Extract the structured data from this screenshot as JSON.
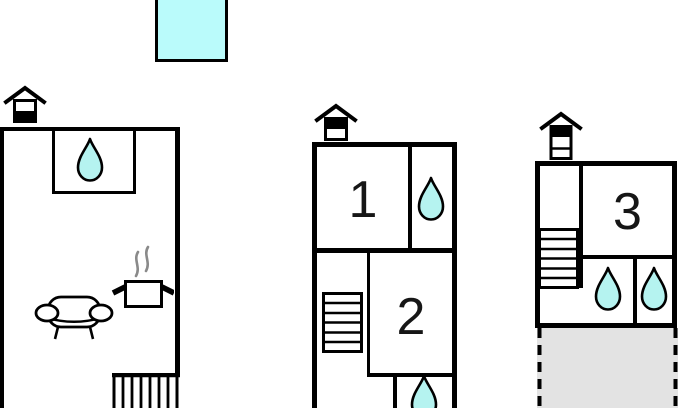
{
  "rooms": [
    {
      "label": "1"
    },
    {
      "label": "2"
    },
    {
      "label": "3"
    }
  ],
  "icons": {
    "pool": "swimming-pool",
    "floor_indicator_unit1": "house-ground-floor-icon",
    "floor_indicator_unit2": "house-upper-floor-icon",
    "floor_indicator_unit3": "house-top-floor-icon",
    "water_drop": "water-drop-icon",
    "sofa": "sofa-icon",
    "cooking_pot": "cooking-pot-steam-icon",
    "staircase": "staircase-icon",
    "terrace": "terrace-patio"
  },
  "colors": {
    "wall": "#000000",
    "water_fill": "#b5f3f0",
    "pool_fill": "#bafbfb",
    "terrace_fill": "#e3e3e3",
    "steam": "#8a8a8a",
    "digit": "#161616"
  }
}
